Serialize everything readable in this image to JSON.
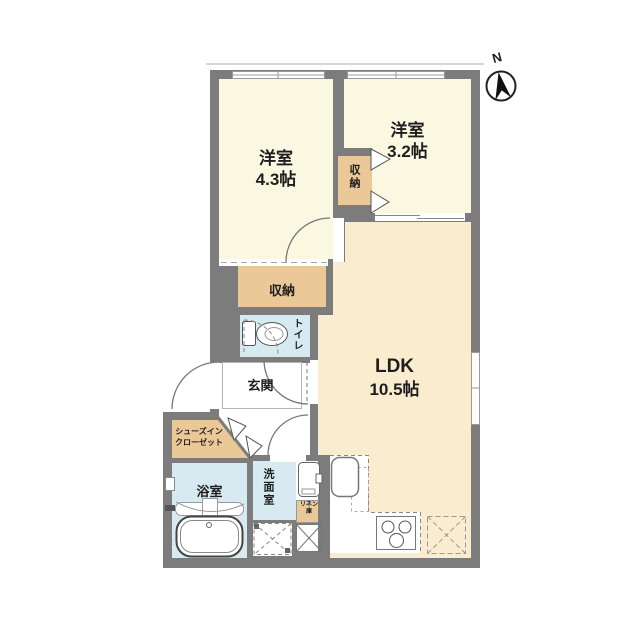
{
  "compass": {
    "label": "N"
  },
  "rooms": {
    "bedroom1": {
      "name": "洋室",
      "size": "4.3帖"
    },
    "bedroom2": {
      "name": "洋室",
      "size": "3.2帖"
    },
    "ldk": {
      "name": "LDK",
      "size": "10.5帖"
    },
    "storage_mid": {
      "name": "収納"
    },
    "storage_low": {
      "name": "収納"
    },
    "toilet": {
      "name": "トイレ"
    },
    "entrance": {
      "name": "玄関"
    },
    "shoe_closet": {
      "line1": "シューズイン",
      "line2": "クローゼット"
    },
    "bathroom": {
      "name": "浴室"
    },
    "washroom": {
      "name": "洗面室"
    },
    "linen": {
      "line1": "リネン",
      "line2": "庫"
    }
  },
  "colors": {
    "wall": "#7c7c7c",
    "bedroom_floor": "#fbf8e2",
    "ldk_floor": "#faeccf",
    "storage_floor": "#eac897",
    "wet_area_floor": "#d7e9f1"
  }
}
